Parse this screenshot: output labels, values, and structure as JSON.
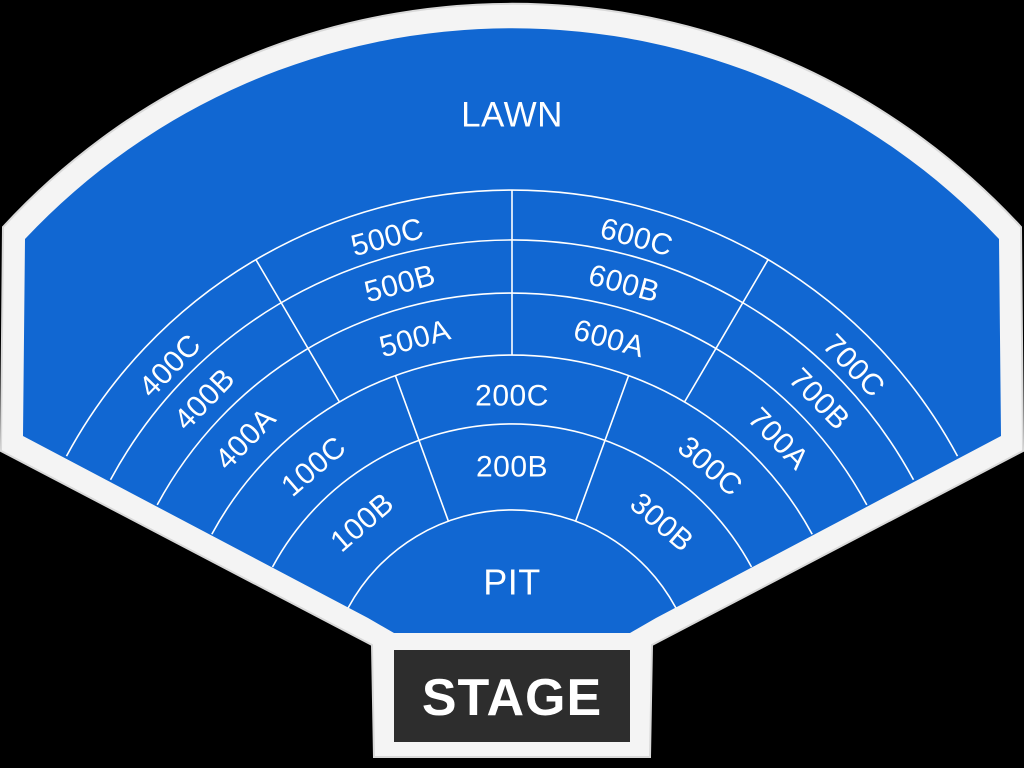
{
  "map": {
    "title": "Amphitheatre seating map",
    "venue_labels": {
      "lawn": "LAWN",
      "pit": "PIT",
      "stage": "STAGE"
    },
    "colors": {
      "background": "#000000",
      "outline": "#f4f4f4",
      "outline_edge": "#d9d9d9",
      "section_fill": "#1167d2",
      "divider": "#ffffff",
      "stage_fill": "#2d2d2d",
      "label_text": "#ffffff"
    },
    "geometry": {
      "center": {
        "x": 512,
        "y": 696
      },
      "sector": {
        "angle_left": 151.7,
        "angle_right": 28.3
      },
      "ring_arcs": [
        186,
        272,
        341,
        403,
        456,
        506
      ],
      "radial_dividers": [
        {
          "between": "500-600",
          "angle": 90,
          "r1": 341,
          "r2": 506
        },
        {
          "between": "400-500",
          "angle": 120.4,
          "r1": 341,
          "r2": 506
        },
        {
          "between": "600-700",
          "angle": 59.6,
          "r1": 341,
          "r2": 506
        },
        {
          "between": "100-200",
          "angle": 110,
          "r1": 186,
          "r2": 341
        },
        {
          "between": "200-300",
          "angle": 70,
          "r1": 186,
          "r2": 341
        }
      ],
      "outline_path": "M 3 227 A 692 692 0 0 1 1021 227 L 1023 451 L 652 645 L 650 757 L 374 757 L 372 645 L 1 451 Z",
      "bowl_path": "M 25 239 A 668 668 0 0 1 999 239 L 1001 436 L 656 618 L 630 633 L 394 633 L 368 618 L 23 436 Z",
      "stage_rect": {
        "x": 394,
        "y": 650,
        "width": 236,
        "height": 92
      },
      "stage_label_pos": {
        "x": 512,
        "y": 698
      }
    },
    "sections": [
      {
        "id": "lawn",
        "label": "LAWN",
        "angle": 90,
        "r": 581,
        "font": 35
      },
      {
        "id": "500c",
        "label": "500C",
        "angle": 105.2,
        "r": 475,
        "font": 30
      },
      {
        "id": "500b",
        "label": "500B",
        "angle": 105.2,
        "r": 427,
        "font": 30
      },
      {
        "id": "500a",
        "label": "500A",
        "angle": 105.2,
        "r": 370,
        "font": 30
      },
      {
        "id": "600c",
        "label": "600C",
        "angle": 74.8,
        "r": 475,
        "font": 30
      },
      {
        "id": "600b",
        "label": "600B",
        "angle": 74.8,
        "r": 427,
        "font": 30
      },
      {
        "id": "600a",
        "label": "600A",
        "angle": 74.8,
        "r": 370,
        "font": 30
      },
      {
        "id": "400c",
        "label": "400C",
        "angle": 136,
        "r": 475,
        "font": 30
      },
      {
        "id": "400b",
        "label": "400B",
        "angle": 136,
        "r": 427,
        "font": 30
      },
      {
        "id": "400a",
        "label": "400A",
        "angle": 136,
        "r": 370,
        "font": 30
      },
      {
        "id": "700c",
        "label": "700C",
        "angle": 44,
        "r": 475,
        "font": 30
      },
      {
        "id": "700b",
        "label": "700B",
        "angle": 44,
        "r": 427,
        "font": 30
      },
      {
        "id": "700a",
        "label": "700A",
        "angle": 44,
        "r": 370,
        "font": 30
      },
      {
        "id": "100c",
        "label": "100C",
        "angle": 130.8,
        "r": 303,
        "font": 30
      },
      {
        "id": "100b",
        "label": "100B",
        "angle": 130.8,
        "r": 229,
        "font": 30
      },
      {
        "id": "200c",
        "label": "200C",
        "angle": 90,
        "r": 300,
        "font": 30
      },
      {
        "id": "200b",
        "label": "200B",
        "angle": 90,
        "r": 229,
        "font": 30
      },
      {
        "id": "300c",
        "label": "300C",
        "angle": 49.2,
        "r": 303,
        "font": 30
      },
      {
        "id": "300b",
        "label": "300B",
        "angle": 49.2,
        "r": 229,
        "font": 30
      },
      {
        "id": "pit",
        "label": "PIT",
        "angle": 90,
        "r": 114,
        "font": 36
      }
    ]
  }
}
